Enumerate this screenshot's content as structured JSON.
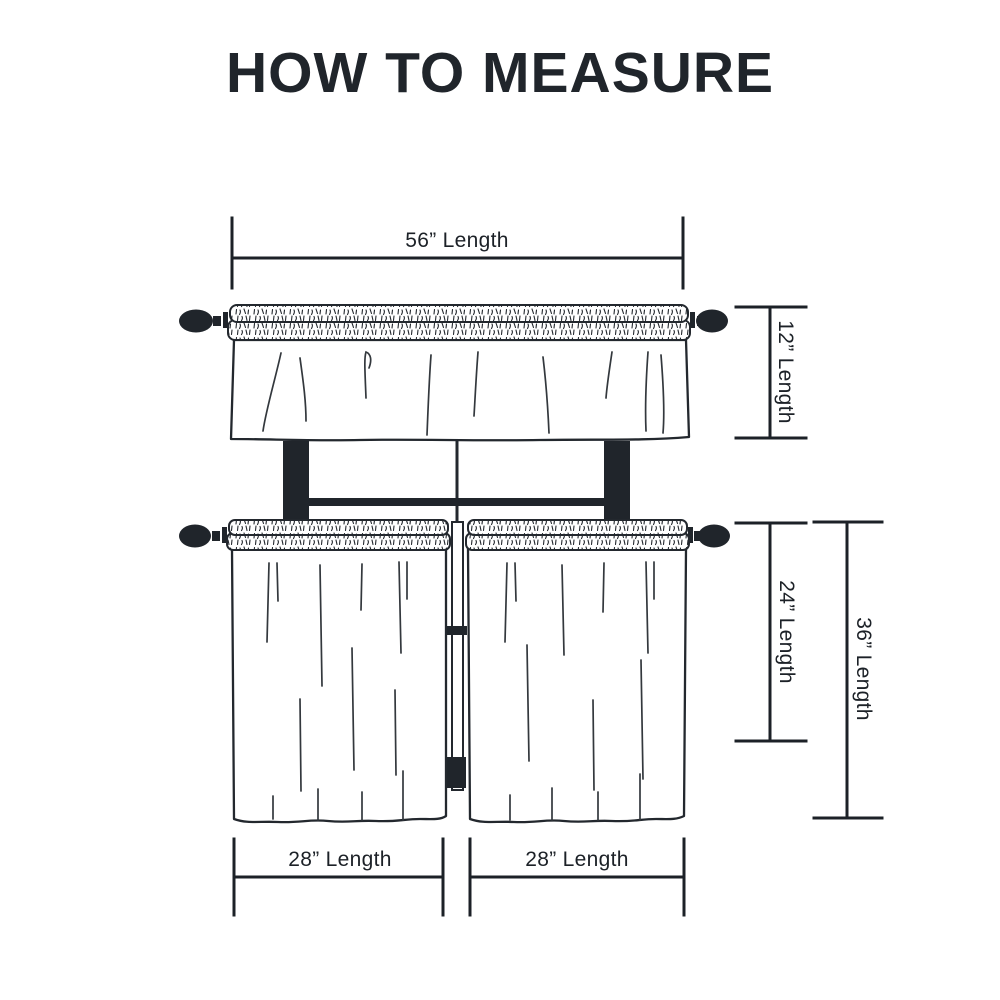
{
  "title": "HOW TO MEASURE",
  "colors": {
    "ink": "#1c2127",
    "background": "#ffffff"
  },
  "unit": "inches",
  "labels": {
    "valance_width": "56” Length",
    "valance_height": "12” Length",
    "tier_height": "24” Length",
    "total_height": "36” Length",
    "left_tier_width": "28” Length",
    "right_tier_width": "28” Length"
  },
  "measurements": {
    "valance_width_in": 56,
    "valance_height_in": 12,
    "tier_height_in": 24,
    "total_height_in": 36,
    "left_tier_width_in": 28,
    "right_tier_width_in": 28
  }
}
